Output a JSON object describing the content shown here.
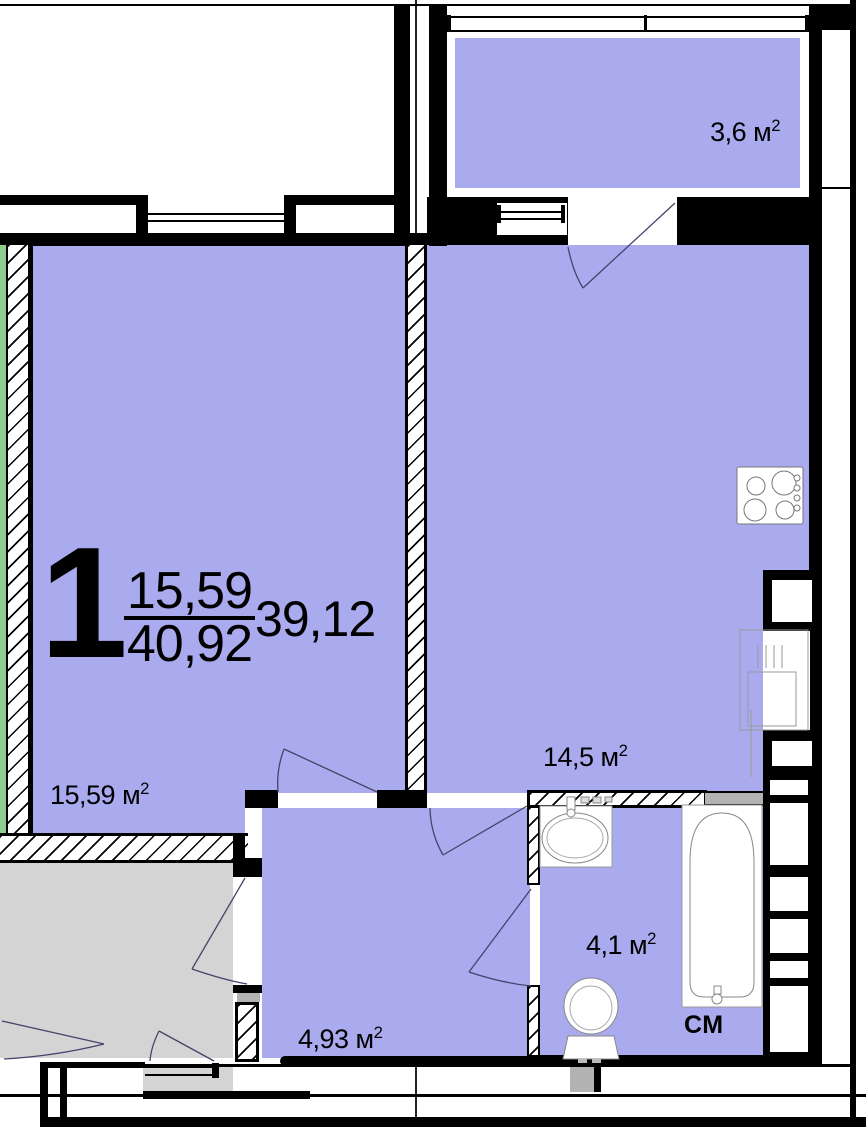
{
  "unit": {
    "rooms": "1",
    "living_area": "15,59",
    "total_area": "40,92",
    "adjusted_area": "39,12"
  },
  "areas": {
    "balcony": {
      "value": "3,6 м",
      "sup": "2"
    },
    "living": {
      "value": "15,59 м",
      "sup": "2"
    },
    "kitchen": {
      "value": "14,5 м",
      "sup": "2"
    },
    "hall": {
      "value": "4,93 м",
      "sup": "2"
    },
    "bath": {
      "value": "4,1 м",
      "sup": "2"
    },
    "washer": {
      "value": "СМ"
    }
  },
  "fixtures": [
    "stove-icon",
    "sink-icon",
    "toilet-icon",
    "bathtub-icon",
    "kitchen-sink-unit-icon"
  ],
  "colors": {
    "room_fill": "#aaaaee",
    "neighbor_fill": "#d4d4d4",
    "insulation_green": "#8fcc8f",
    "wall_black": "#000000",
    "duct_gray": "#b3b3b3",
    "door_arc": "#44446a"
  }
}
